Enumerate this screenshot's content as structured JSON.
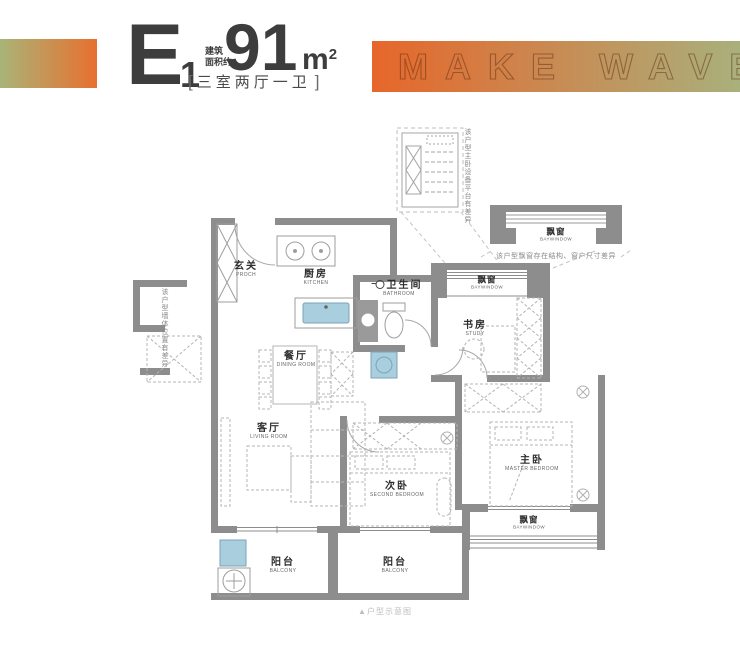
{
  "header": {
    "unit_code": "E",
    "unit_index": "1",
    "area_label_top": "建筑",
    "area_label_bottom": "面积约",
    "area_value": "91",
    "area_unit_base": "m",
    "area_unit_sup": "2",
    "bracket_open": "[",
    "bracket_close": "]",
    "layout_text": "三室两厅一卫",
    "banner_text": "MAKE WAVE"
  },
  "plan": {
    "rooms": {
      "porch": {
        "cn": "玄关",
        "en": "PROCH"
      },
      "kitchen": {
        "cn": "厨房",
        "en": "KITCHEN"
      },
      "bathroom": {
        "cn": "卫生间",
        "en": "BATHROOM"
      },
      "study": {
        "cn": "书房",
        "en": "STUDY"
      },
      "dining": {
        "cn": "餐厅",
        "en": "DINING ROOM"
      },
      "living": {
        "cn": "客厅",
        "en": "LIVING ROOM"
      },
      "second_bedroom": {
        "cn": "次卧",
        "en": "SECOND BEDROOM"
      },
      "master_bedroom": {
        "cn": "主卧",
        "en": "MASTER BEDROOM"
      },
      "balcony_left": {
        "cn": "阳台",
        "en": "BALCONY"
      },
      "balcony_right": {
        "cn": "阳台",
        "en": "BALCONY"
      },
      "baywindow_study": {
        "cn": "飘窗",
        "en": "BAYWINDOW"
      },
      "baywindow_master": {
        "cn": "飘窗",
        "en": "BAYWINDOW"
      },
      "baywindow_detail": {
        "cn": "飘窗",
        "en": "BAYWINDOW"
      }
    },
    "notes": {
      "detail_section_note": "该户型主卧设备平台有差异",
      "baywindow_note": "该户型飘窗存在结构、窗户尺寸差异",
      "left_wing_note": "该户型墙体位置有差异",
      "caption": "▲户型示意图"
    }
  },
  "colors": {
    "gradient_green": "#a9b478",
    "gradient_orange": "#e8702f",
    "wall_gray": "#8d8d8d",
    "fixture_blue": "#a9cede",
    "title_dark": "#3d3d3d"
  }
}
